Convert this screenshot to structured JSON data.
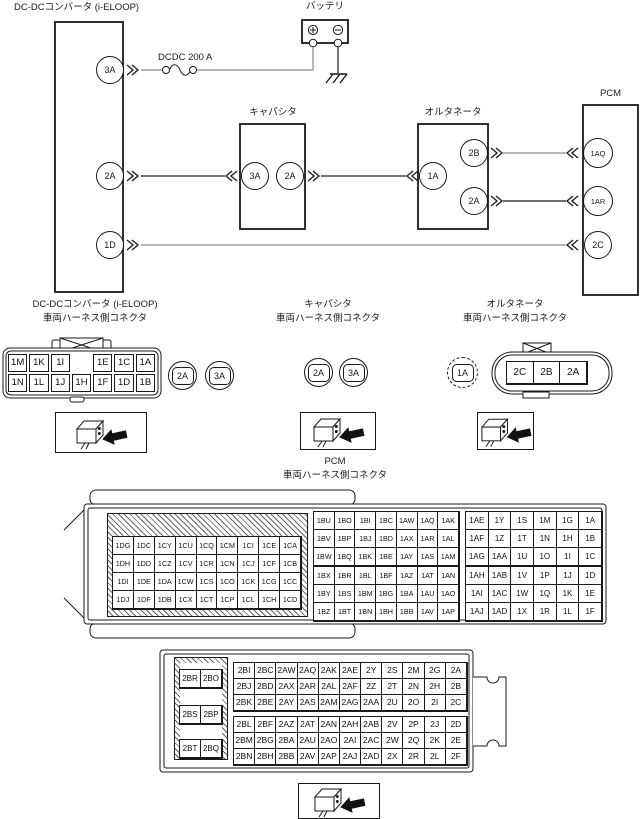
{
  "colors": {
    "line": "#1a1a1a",
    "wire_gray": "#8a8a8a",
    "background": "#ffffff"
  },
  "diagram": {
    "dcdc": {
      "label": "DC-DCコンバータ (i-ELOOP)",
      "pins": [
        "3A",
        "2A",
        "1D"
      ]
    },
    "battery": {
      "label": "バッテリ"
    },
    "fuse": {
      "label": "DCDC 200 A"
    },
    "capacitor": {
      "label": "キャパシタ",
      "pins": [
        "3A",
        "2A"
      ]
    },
    "alternator": {
      "label": "オルタネータ",
      "pins": [
        "1A",
        "2B",
        "2A"
      ]
    },
    "pcm": {
      "label": "PCM",
      "pins": [
        "1AQ",
        "1AR",
        "2C"
      ]
    }
  },
  "connector_sections": {
    "harness_label": "車両ハーネス側コネクタ",
    "dcdc": {
      "title": "DC-DCコンバータ (i-ELOOP)",
      "grid": [
        [
          "1M",
          "1K",
          "1I",
          "",
          "1E",
          "1C",
          "1A"
        ],
        [
          "1N",
          "1L",
          "1J",
          "1H",
          "1F",
          "1D",
          "1B"
        ]
      ],
      "badges": [
        "2A",
        "3A"
      ]
    },
    "capacitor": {
      "title": "キャパシタ",
      "badges": [
        "2A",
        "3A"
      ]
    },
    "alternator": {
      "title": "オルタネータ",
      "badge": "1A",
      "grid": [
        [
          "2C",
          "2B",
          "2A"
        ]
      ]
    },
    "pcm": {
      "title": "PCM",
      "grid1_left": [
        [
          "1DG",
          "1DC",
          "1CY",
          "1CU",
          "1CQ",
          "1CM",
          "1CI",
          "1CE",
          "1CA"
        ],
        [
          "1DH",
          "1DD",
          "1CZ",
          "1CV",
          "1CR",
          "1CN",
          "1CJ",
          "1CF",
          "1CB"
        ],
        [
          "1DI",
          "1DE",
          "1DA",
          "1CW",
          "1CS",
          "1CO",
          "1CK",
          "1CG",
          "1CC"
        ],
        [
          "1DJ",
          "1DF",
          "1DB",
          "1CX",
          "1CT",
          "1CP",
          "1CL",
          "1CH",
          "1CD"
        ]
      ],
      "grid1_mid_top": [
        [
          "1BU",
          "1BO",
          "1BI",
          "1BC",
          "1AW",
          "1AQ",
          "1AK"
        ],
        [
          "1BV",
          "1BP",
          "1BJ",
          "1BD",
          "1AX",
          "1AR",
          "1AL"
        ],
        [
          "1BW",
          "1BQ",
          "1BK",
          "1BE",
          "1AY",
          "1AS",
          "1AM"
        ]
      ],
      "grid1_mid_bottom": [
        [
          "1BX",
          "1BR",
          "1BL",
          "1BF",
          "1AZ",
          "1AT",
          "1AN"
        ],
        [
          "1BY",
          "1BS",
          "1BM",
          "1BG",
          "1BA",
          "1AU",
          "1AO"
        ],
        [
          "1BZ",
          "1BT",
          "1BN",
          "1BH",
          "1BB",
          "1AV",
          "1AP"
        ]
      ],
      "grid1_right_top": [
        [
          "1AE",
          "1Y",
          "1S",
          "1M",
          "1G",
          "1A"
        ],
        [
          "1AF",
          "1Z",
          "1T",
          "1N",
          "1H",
          "1B"
        ],
        [
          "1AG",
          "1AA",
          "1U",
          "1O",
          "1I",
          "1C"
        ]
      ],
      "grid1_right_bottom": [
        [
          "1AH",
          "1AB",
          "1V",
          "1P",
          "1J",
          "1D"
        ],
        [
          "1AI",
          "1AC",
          "1W",
          "1Q",
          "1K",
          "1E"
        ],
        [
          "1AJ",
          "1AD",
          "1X",
          "1R",
          "1L",
          "1F"
        ]
      ],
      "grid2_left": [
        [
          "2BR",
          "2BO"
        ],
        [
          "2BS",
          "2BP"
        ],
        [
          "2BT",
          "2BQ"
        ]
      ],
      "grid2_top": [
        [
          "2BI",
          "2BC",
          "2AW",
          "2AQ",
          "2AK",
          "2AE",
          "2Y",
          "2S",
          "2M",
          "2G",
          "2A"
        ],
        [
          "2BJ",
          "2BD",
          "2AX",
          "2AR",
          "2AL",
          "2AF",
          "2Z",
          "2T",
          "2N",
          "2H",
          "2B"
        ],
        [
          "2BK",
          "2BE",
          "2AY",
          "2AS",
          "2AM",
          "2AG",
          "2AA",
          "2U",
          "2O",
          "2I",
          "2C"
        ]
      ],
      "grid2_bottom": [
        [
          "2BL",
          "2BF",
          "2AZ",
          "2AT",
          "2AN",
          "2AH",
          "2AB",
          "2V",
          "2P",
          "2J",
          "2D"
        ],
        [
          "2BM",
          "2BG",
          "2BA",
          "2AU",
          "2AO",
          "2AI",
          "2AC",
          "2W",
          "2Q",
          "2K",
          "2E"
        ],
        [
          "2BN",
          "2BH",
          "2BB",
          "2AV",
          "2AP",
          "2AJ",
          "2AD",
          "2X",
          "2R",
          "2L",
          "2F"
        ]
      ]
    }
  }
}
